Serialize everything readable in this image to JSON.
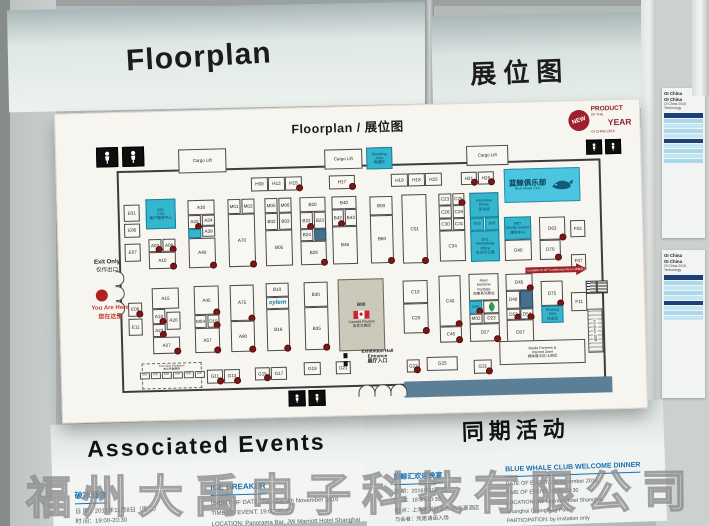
{
  "headers": {
    "top_left": "Floorplan",
    "top_right": "展位图",
    "bottom_left": "Associated Events",
    "bottom_right": "同期活动"
  },
  "watermark": "福州大禹电子科技有限公司",
  "seal": {
    "badge": "NEW",
    "l1": "PRODUCT",
    "l2a": "OF THE",
    "l2b": "YEAR",
    "l3": "OI CHINA 2016"
  },
  "colors": {
    "teal_booth": "#35b6cf",
    "whale_box": "#4cc6e0",
    "dark_booth": "#44708e",
    "red_dot": "#7e1616",
    "seal_red": "#9e2030",
    "wall_bar": "#5b7f96",
    "heading_blue": "#1b6fae"
  },
  "floorplan": {
    "title": "Floorplan / 展位图",
    "exit_en": "Exit Only",
    "exit_zh": "仅作出口",
    "you_are_here_en": "You Are Here",
    "you_are_here_zh": "您在这里",
    "entrance_lines": [
      "Exhibition Hall",
      "Entrance",
      "展厅入口"
    ],
    "escalator_note": "Escalator to 3/F Conference Room 扶梯至三楼会议室",
    "escalator_label": "Escalator 扶梯",
    "first_time_items": [
      "G01",
      "G02",
      "G03",
      "G04",
      "G05",
      "G06"
    ],
    "booths": [
      [
        "WC",
        30,
        4,
        22,
        20,
        "wc"
      ],
      [
        "WC",
        56,
        4,
        22,
        20,
        "wc"
      ],
      [
        "Cargo Lift",
        112,
        8,
        48,
        24,
        "cargo"
      ],
      [
        "Cargo Lift",
        258,
        12,
        38,
        20,
        "cargo"
      ],
      [
        "Smoking Area",
        300,
        11,
        26,
        22,
        "teal",
        0,
        "Smoking\nArea\n吸烟区"
      ],
      [
        "Cargo Lift",
        400,
        12,
        42,
        20,
        "cargo"
      ],
      [
        "WC",
        520,
        9,
        16,
        15,
        "wc"
      ],
      [
        "WC",
        539,
        9,
        16,
        15,
        "wc"
      ],
      [
        "WC",
        216,
        252,
        17,
        16,
        "wc"
      ],
      [
        "WC",
        236,
        252,
        17,
        16,
        "wc"
      ],
      [
        "H09",
        184,
        38,
        17,
        14
      ],
      [
        "H13",
        201,
        38,
        17,
        14
      ],
      [
        "H15",
        218,
        38,
        17,
        14,
        "",
        1
      ],
      [
        "H17",
        262,
        38,
        26,
        14,
        "",
        1
      ],
      [
        "H19",
        324,
        38,
        17,
        13
      ],
      [
        "H18",
        341,
        38,
        17,
        13
      ],
      [
        "H25",
        358,
        38,
        17,
        13
      ],
      [
        "H21",
        394,
        38,
        16,
        13,
        "",
        1
      ],
      [
        "H26",
        411,
        38,
        16,
        13,
        "",
        1
      ],
      [
        "Blue Whale Club",
        437,
        36,
        76,
        34,
        "whale",
        0,
        "蓝鲸俱乐部\nBlue Whale Club"
      ],
      [
        "E01",
        56,
        62,
        16,
        17
      ],
      [
        "E06",
        56,
        81,
        16,
        14
      ],
      [
        "E07",
        56,
        101,
        16,
        18
      ],
      [
        "A01",
        78,
        57,
        30,
        30,
        "teal",
        0,
        "A01\nCSC\n客户服务中心"
      ],
      [
        "A03",
        80,
        97,
        13,
        13,
        "",
        1
      ],
      [
        "A08",
        94,
        97,
        13,
        13,
        "",
        1
      ],
      [
        "A10",
        80,
        110,
        27,
        17,
        "",
        1
      ],
      [
        "E09",
        58,
        160,
        14,
        14,
        "",
        1
      ],
      [
        "E11",
        58,
        176,
        14,
        17
      ],
      [
        "A15",
        82,
        146,
        27,
        21
      ],
      [
        "A18",
        82,
        167,
        13,
        15,
        "",
        1
      ],
      [
        "A20",
        96,
        170,
        14,
        18
      ],
      [
        "A23",
        82,
        182,
        13,
        13,
        "",
        1
      ],
      [
        "A27",
        82,
        195,
        27,
        17,
        "",
        1
      ],
      [
        "A30",
        120,
        59,
        27,
        15
      ],
      [
        "A33",
        120,
        74,
        13,
        14,
        "",
        1
      ],
      [
        "A34",
        134,
        74,
        13,
        11
      ],
      [
        "A38",
        134,
        85,
        13,
        11
      ],
      [
        "",
        120,
        88,
        13,
        9,
        "teal",
        0,
        ""
      ],
      [
        "A40",
        120,
        97,
        27,
        30,
        "",
        1
      ],
      [
        "A45",
        124,
        145,
        25,
        29,
        "",
        1
      ],
      [
        "M04",
        124,
        174,
        12,
        13
      ],
      [
        "D15",
        137,
        174,
        12,
        13,
        "",
        1
      ],
      [
        "A57",
        124,
        187,
        25,
        25,
        "",
        1
      ],
      [
        "M01",
        160,
        59,
        13,
        15
      ],
      [
        "M03",
        174,
        59,
        13,
        15
      ],
      [
        "A70",
        160,
        74,
        27,
        53,
        "",
        1
      ],
      [
        "A75",
        160,
        145,
        24,
        36,
        "",
        1
      ],
      [
        "A90",
        160,
        181,
        24,
        31,
        "",
        1
      ],
      [
        "M05",
        197,
        59,
        13,
        15
      ],
      [
        "M06",
        211,
        59,
        13,
        15
      ],
      [
        "B02",
        197,
        74,
        13,
        17
      ],
      [
        "B03",
        211,
        74,
        13,
        17
      ],
      [
        "B05",
        197,
        91,
        27,
        36
      ],
      [
        "B10",
        196,
        144,
        23,
        14
      ],
      [
        "xylem",
        196,
        158,
        23,
        12,
        "xylem",
        0,
        "xylem"
      ],
      [
        "B18",
        196,
        170,
        23,
        42,
        "",
        1
      ],
      [
        "B20",
        232,
        59,
        26,
        15
      ],
      [
        "B22",
        232,
        74,
        13,
        17,
        "",
        1
      ],
      [
        "B23",
        246,
        74,
        12,
        17
      ],
      [
        "B24",
        232,
        91,
        13,
        12
      ],
      [
        "",
        246,
        91,
        12,
        12,
        "dark",
        0,
        ""
      ],
      [
        "B26",
        232,
        103,
        26,
        24,
        "",
        1
      ],
      [
        "B30",
        234,
        144,
        24,
        25
      ],
      [
        "B35",
        234,
        169,
        24,
        43,
        "",
        1
      ],
      [
        "B40",
        264,
        59,
        25,
        13
      ],
      [
        "B42",
        264,
        72,
        12,
        17,
        "",
        1
      ],
      [
        "B43",
        277,
        72,
        12,
        17
      ],
      [
        "B46",
        264,
        89,
        25,
        38
      ],
      [
        "B80",
        268,
        142,
        46,
        72,
        "canada",
        0,
        "B80\nCanada Pavilion\n加拿大展团"
      ],
      [
        "B50",
        302,
        60,
        23,
        19
      ],
      [
        "B60",
        302,
        79,
        23,
        48,
        "",
        1
      ],
      [
        "C01",
        334,
        59,
        25,
        69,
        "",
        1
      ],
      [
        "C10",
        333,
        145,
        25,
        23
      ],
      [
        "C20",
        333,
        168,
        25,
        30,
        "",
        1
      ],
      [
        "C23",
        371,
        59,
        13,
        12
      ],
      [
        "C25",
        385,
        59,
        12,
        12,
        "",
        1
      ],
      [
        "C26",
        371,
        71,
        13,
        13
      ],
      [
        "C28",
        385,
        71,
        12,
        13
      ],
      [
        "C30",
        371,
        84,
        13,
        12
      ],
      [
        "C31",
        385,
        84,
        12,
        12
      ],
      [
        "C34",
        371,
        96,
        26,
        31
      ],
      [
        "C40",
        369,
        141,
        22,
        51,
        "",
        1
      ],
      [
        "C45",
        369,
        192,
        22,
        16,
        "",
        1
      ],
      [
        "Interview Room",
        402,
        59,
        29,
        25,
        "teal",
        0,
        "Interview\nRoom\n采访间"
      ],
      [
        "D03",
        402,
        84,
        14,
        13,
        "teal"
      ],
      [
        "D05",
        417,
        84,
        14,
        13,
        "teal"
      ],
      [
        "D01",
        402,
        97,
        29,
        31,
        "teal",
        0,
        "D01\nRebooking\nOffice\n主办办公室"
      ],
      [
        "Maritime Portfolio",
        399,
        140,
        30,
        27,
        "",
        0,
        "Meet\nMaritime\nPortfolio\n海事系列展会"
      ],
      [
        "D20",
        399,
        167,
        13,
        13,
        "teal",
        1
      ],
      [
        "",
        413,
        167,
        16,
        13,
        "leaf"
      ],
      [
        "M02",
        399,
        180,
        13,
        10
      ],
      [
        "D22",
        413,
        180,
        16,
        10
      ],
      [
        "D27",
        399,
        190,
        30,
        18,
        "",
        1
      ],
      [
        "M07",
        436,
        84,
        27,
        23,
        "teal",
        0,
        "M07\nMedia Center\n媒体中心"
      ],
      [
        "D40",
        436,
        107,
        27,
        21
      ],
      [
        "D45",
        436,
        141,
        27,
        17,
        "",
        1
      ],
      [
        "D49",
        436,
        158,
        14,
        18
      ],
      [
        "",
        450,
        158,
        13,
        18,
        "dark",
        0,
        ""
      ],
      [
        "D53",
        436,
        176,
        14,
        11,
        "",
        1
      ],
      [
        "D54",
        450,
        176,
        13,
        11,
        "",
        1
      ],
      [
        "D57",
        436,
        187,
        27,
        25
      ],
      [
        "D63",
        471,
        85,
        26,
        23,
        "",
        1
      ],
      [
        "D70",
        471,
        108,
        21,
        20,
        "",
        1
      ],
      [
        "D75",
        471,
        149,
        22,
        25,
        "",
        1
      ],
      [
        "Resting Area",
        471,
        174,
        22,
        17,
        "teal",
        0,
        "Resting\nArea\n休息区"
      ],
      [
        "F03",
        502,
        89,
        15,
        17
      ],
      [
        "F07",
        502,
        123,
        15,
        14
      ],
      [
        "F11",
        501,
        161,
        16,
        19
      ],
      [
        "First Time Exhibitors",
        70,
        221,
        60,
        26,
        "ft",
        0,
        "First Time Exhibitors\n首次参展展商"
      ],
      [
        "G11",
        135,
        229,
        16,
        14,
        "",
        1
      ],
      [
        "G13",
        152,
        229,
        16,
        14,
        "",
        1
      ],
      [
        "G15",
        183,
        228,
        15,
        13,
        "",
        1
      ],
      [
        "G17",
        199,
        228,
        16,
        13
      ],
      [
        "G19",
        232,
        224,
        17,
        13
      ],
      [
        "G21",
        264,
        224,
        15,
        13
      ],
      [
        "G23",
        335,
        224,
        13,
        13,
        "",
        1
      ],
      [
        "G25",
        355,
        222,
        31,
        14
      ],
      [
        "G31",
        402,
        226,
        18,
        14,
        "",
        1
      ],
      [
        "Media Partners & Internet Zone",
        428,
        208,
        86,
        24,
        "",
        0,
        "Media Partners &\nInternet Zone\n媒体展示区/上网区"
      ]
    ]
  },
  "events_left": {
    "heading": "Associated Events",
    "zh": {
      "title": "破冰酒会",
      "lines": [
        "日 期：2016年11月8日（周二）",
        "时 间：19:00-20:30",
        "地 点：上海新发展亚太JW万豪酒店 云景吧"
      ]
    },
    "en": {
      "title": "ICE BREAKER",
      "lines": [
        "EVENT OF DATE: Tuesday 8th November 2016",
        "TIME OF EVENT: 19:00-20:30",
        "LOCATION: Panorama Bar, JW Marriott Hotel Shanghai",
        "Changfeng Park"
      ]
    }
  },
  "events_right": {
    "heading": "同期活动",
    "zh": {
      "title": "蓝鲸汇欢迎晚宴",
      "lines": [
        "日 期：2016年11月7日",
        "时 间：18:30-20:30",
        "地 点：上海新发展亚太JW万豪酒店",
        "与会者：凭邀请函入场"
      ]
    },
    "en": {
      "title": "BLUE WHALE CLUB WELCOME DINNER",
      "lines": [
        "DATE OF EVENT: 7th November 2016",
        "TIME OF EVENT: 18:30-20:30",
        "LOCATION: JW Marriott Hotel Shanghai,",
        "Shanghai Changfeng Park",
        "PARTICIPATION: by invitation only"
      ]
    }
  },
  "side": {
    "cards": [
      {
        "titles": [
          "OI China",
          "OI China",
          "OI China 2016",
          "Technology"
        ],
        "rows": 9
      },
      {
        "titles": [
          "OI China",
          "OI China",
          "OI China 2016",
          "Technology"
        ],
        "rows": 8
      }
    ]
  }
}
